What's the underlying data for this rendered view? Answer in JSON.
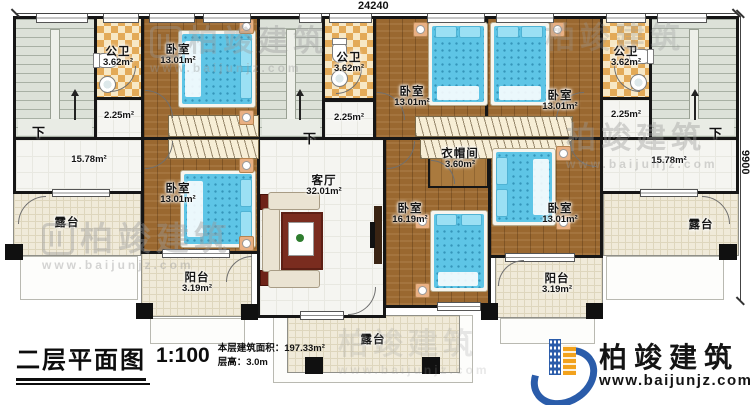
{
  "dimensions": {
    "top": "24240",
    "right": "9900"
  },
  "title_block": {
    "title": "二层平面图",
    "scale": "1:100",
    "area": "本层建筑面积：197.33m²",
    "floor_height": "层高：3.0m"
  },
  "logo": {
    "name": "柏竣建筑",
    "website": "www.baijunjz.com"
  },
  "watermark": {
    "name": "柏竣建筑",
    "website": "www.baijunjz.com"
  },
  "stairs": {
    "down": "下"
  },
  "rooms": [
    {
      "id": "bath-left",
      "name": "公卫",
      "area": "3.62m²"
    },
    {
      "id": "bedroom-top-left",
      "name": "卧室",
      "area": "13.01m²"
    },
    {
      "id": "hall-left-small",
      "name": "",
      "area": "2.25m²"
    },
    {
      "id": "hall-left",
      "name": "",
      "area": "15.78m²"
    },
    {
      "id": "bedroom-bottom-left",
      "name": "卧室",
      "area": "13.01m²"
    },
    {
      "id": "terrace-left",
      "name": "露台",
      "area": ""
    },
    {
      "id": "balcony-left",
      "name": "阳台",
      "area": "3.19m²"
    },
    {
      "id": "living-room",
      "name": "客厅",
      "area": "32.01m²"
    },
    {
      "id": "bath-middle",
      "name": "公卫",
      "area": "3.62m²"
    },
    {
      "id": "hall-middle-small",
      "name": "",
      "area": "2.25m²"
    },
    {
      "id": "bedroom-top-middle-left",
      "name": "卧室",
      "area": "13.01m²"
    },
    {
      "id": "bedroom-top-middle-right",
      "name": "卧室",
      "area": "13.01m²"
    },
    {
      "id": "cloakroom",
      "name": "衣帽间",
      "area": "3.60m²"
    },
    {
      "id": "bedroom-master",
      "name": "卧室",
      "area": "16.19m²"
    },
    {
      "id": "bedroom-bottom-middle",
      "name": "卧室",
      "area": "13.01m²"
    },
    {
      "id": "balcony-right",
      "name": "阳台",
      "area": "3.19m²"
    },
    {
      "id": "terrace-bottom",
      "name": "露台",
      "area": ""
    },
    {
      "id": "bath-right",
      "name": "公卫",
      "area": "3.62m²"
    },
    {
      "id": "hall-right-small",
      "name": "",
      "area": "2.25m²"
    },
    {
      "id": "hall-right",
      "name": "",
      "area": "15.78m²"
    },
    {
      "id": "terrace-right",
      "name": "露台",
      "area": ""
    }
  ],
  "colors": {
    "wall": "#161616",
    "wood_floor": "#9a6830",
    "bath_tile": "#e3aa58",
    "bed_blue": "#5ec5e6",
    "terrace_tile": "#f0ead9",
    "stair_floor": "#dce1d8",
    "logo_blue": "#2a5caa",
    "logo_orange": "#f2a21d"
  }
}
